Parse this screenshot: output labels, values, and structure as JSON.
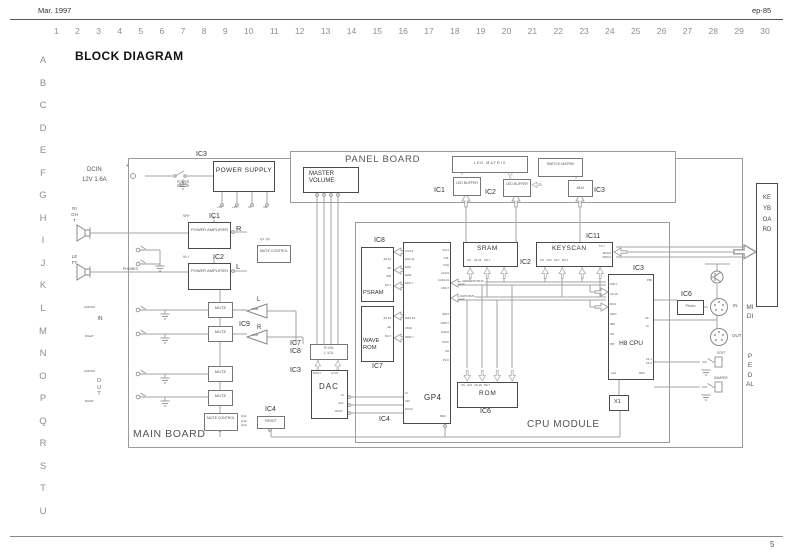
{
  "page": {
    "date": "Mar. 1997",
    "model": "ep-85",
    "page_number": "5",
    "title": "BLOCK DIAGRAM",
    "ruler_cols": [
      "1",
      "2",
      "3",
      "4",
      "5",
      "6",
      "7",
      "8",
      "9",
      "10",
      "11",
      "12",
      "13",
      "14",
      "15",
      "16",
      "17",
      "18",
      "19",
      "20",
      "21",
      "22",
      "23",
      "24",
      "25",
      "26",
      "27",
      "28",
      "29",
      "30"
    ],
    "ruler_rows": [
      "A",
      "B",
      "C",
      "D",
      "E",
      "F",
      "G",
      "H",
      "I",
      "J",
      "K",
      "L",
      "M",
      "N",
      "O",
      "P",
      "Q",
      "R",
      "S",
      "T",
      "U"
    ]
  },
  "boards": {
    "main": "MAIN BOARD",
    "panel": "PANEL BOARD",
    "cpu_module": "CPU MODULE",
    "keyboard": "KEYBOARD",
    "midi": "MIDI",
    "pedal": "PEDAL"
  },
  "power": {
    "dcin": "DCIN",
    "rating": "12V 1.6A",
    "plus": "+",
    "ic": "IC3",
    "switch": "POWER SWITCH",
    "supply": "POWER SUPPLY",
    "outputs": [
      "+5V",
      "+9V",
      "VL",
      "VR"
    ]
  },
  "panel": {
    "master_volume": "MASTER VOLUME",
    "led_matrix": "LED MATRIX",
    "ic1": "IC1",
    "led_buffer_1": "LED BUFFER",
    "ic2": "IC2",
    "led_buffer_2": "LED BUFFER",
    "switch_matrix": "SWITCH MATRIX",
    "ic3": "IC3",
    "mux": "MUX"
  },
  "amp": {
    "ic1": "IC1",
    "power_amp_r": "POWER AMPLIFIER",
    "r": "R",
    "vr": "VR+",
    "ic2": "IC2",
    "power_amp_l": "POWER AMPLIFIER",
    "l": "L",
    "vl": "VL+",
    "mute_control_top": "MUTE CONTROL",
    "q_top": "Q1  Q2",
    "right": "RIGHT",
    "left": "LEFT",
    "phones": "PHONES"
  },
  "mute": {
    "label": "MUTE",
    "ic9": "IC9",
    "amp": "AMP",
    "l": "L",
    "r": "R",
    "control": "MUTE CONTROL",
    "q_list": "Q11\nQ12\nQ13",
    "ic4": "IC4",
    "reset": "RESET"
  },
  "io": {
    "in_mono": "L/MONO",
    "in": "IN",
    "in_right": "RIGHT",
    "out_mono": "L/MONO",
    "out": "OUT",
    "out_right": "RIGHT"
  },
  "dac": {
    "ic7": "IC7",
    "ic8": "IC8",
    "vol": [
      "R-VOL",
      "L-VOL"
    ],
    "ic3": "IC3",
    "label": "DAC",
    "rout": "ROUT",
    "lout": "LOUT",
    "si": "SI",
    "clk": "CLK",
    "lrck": "LRCK",
    "ic4": "IC4"
  },
  "mem": {
    "ic8": "IC8",
    "psram": "PSRAM",
    "psram_pins": [
      "A0-14",
      "OE",
      "WR",
      "D0-7"
    ],
    "wave_rom": "WAVE ROM",
    "wave_pins": [
      "A0-19",
      "CE",
      "D0-7"
    ],
    "ic7": "IC7",
    "gp4": "GP4",
    "gp4_left_top": [
      "CO0-3",
      "EA0-14",
      "EOE",
      "EWE",
      "ED0-7"
    ],
    "gp4_left_mid": [
      "WA0-19",
      "WOE",
      "WD0-7"
    ],
    "gp4_left_bot": [
      "SI",
      "SDI",
      "DACC"
    ],
    "gp4_right_top": [
      "IC0-2",
      "CSL",
      "CSH",
      "CA0-9",
      "CA10-19",
      "CD0-7"
    ],
    "gp4_right_mid": [
      "WAIT",
      "GPINT",
      "DA0-8",
      "IOCK",
      "D0",
      "PV-0"
    ],
    "gp4_res": "RES"
  },
  "cpu": {
    "sram": "SRAM",
    "sram_pins": "CS    A0-14    D0-7",
    "ic2": "IC2",
    "ic11": "IC11",
    "keyscan": "KEYSCAN",
    "keyscan_pins": "CS   CS4   A0-7   D0-7",
    "keyscan_t": "T0-7",
    "keyscan_mk": "MK0-9\nMD0-9",
    "address_bus": "ADDRESS BUS",
    "data_bus": "DATA BUS",
    "rom": "ROM",
    "rom_pins": "CS   A19   A0-18   D0-7",
    "ic6": "IC6",
    "ic3": "IC3",
    "h8": "H8 CPU",
    "h8_left": [
      "P00-7",
      "A0-19",
      "D0-3",
      "WAIT",
      "IMD",
      "INT",
      "PW"
    ],
    "h8_p80": "P80",
    "h8_sk": "SK",
    "h8_si": "SI",
    "h8_ff": "FF-1\nFF-0",
    "h8_xtal": "XAL",
    "h8_res": "RES",
    "x1": "X1",
    "photo_ic": "IC6",
    "photo": "Photo"
  },
  "midi": {
    "in": "IN",
    "out": "OUT"
  },
  "pedal": {
    "soft": "SOFT",
    "damper": "DAMPER"
  },
  "colors": {
    "line": "#9a9a9a",
    "box_border": "#555555",
    "ink": "#444444",
    "ruler": "#8e8e8e",
    "bg": "#ffffff"
  }
}
